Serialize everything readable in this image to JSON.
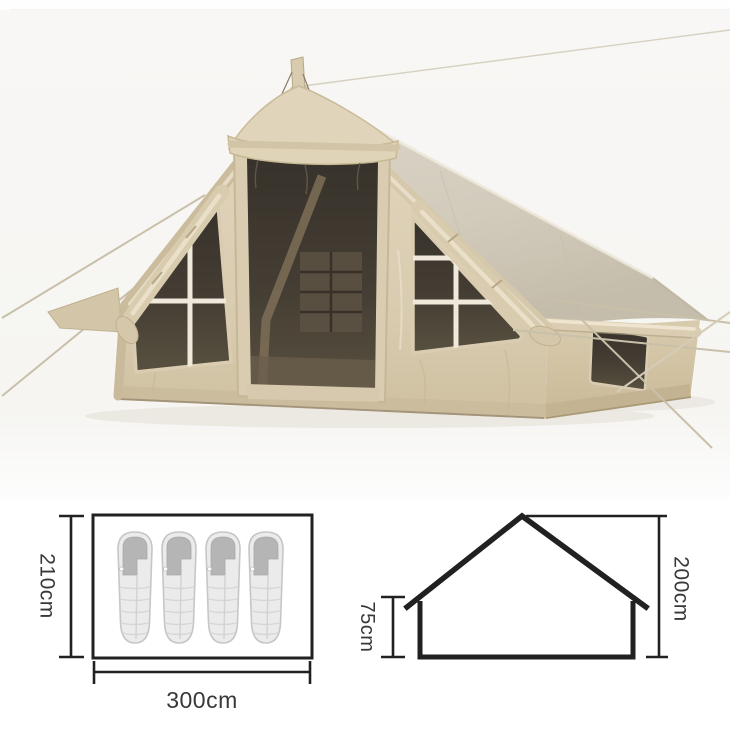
{
  "image": {
    "kind": "product dimension sheet",
    "subject": "inflatable canvas cabin tent with mesh door and windows"
  },
  "photo": {
    "alt": "beige inflatable glamping tent, front-left view",
    "palette": {
      "backdrop": "#f7f6f3",
      "canvas": "#ddd1b6",
      "canvas_shade": "#cbbc9d",
      "roof": "#d8d1c3",
      "roof_shade": "#c6beac",
      "mesh": "#3e3830",
      "trim_highlight": "#ece2cd",
      "rope": "#c9c0aa",
      "skirt": "#cbbc9e"
    }
  },
  "floor_plan": {
    "depth_label": "210cm",
    "width_label": "300cm",
    "sleeping_bag_count": 4,
    "bag_color": "#ebebeb",
    "bag_hood_color": "#b5b5b5"
  },
  "side_profile": {
    "wall_height_label": "75cm",
    "peak_height_label": "200cm"
  },
  "style": {
    "diagram_line_color": "#212121",
    "label_color": "#383838"
  }
}
